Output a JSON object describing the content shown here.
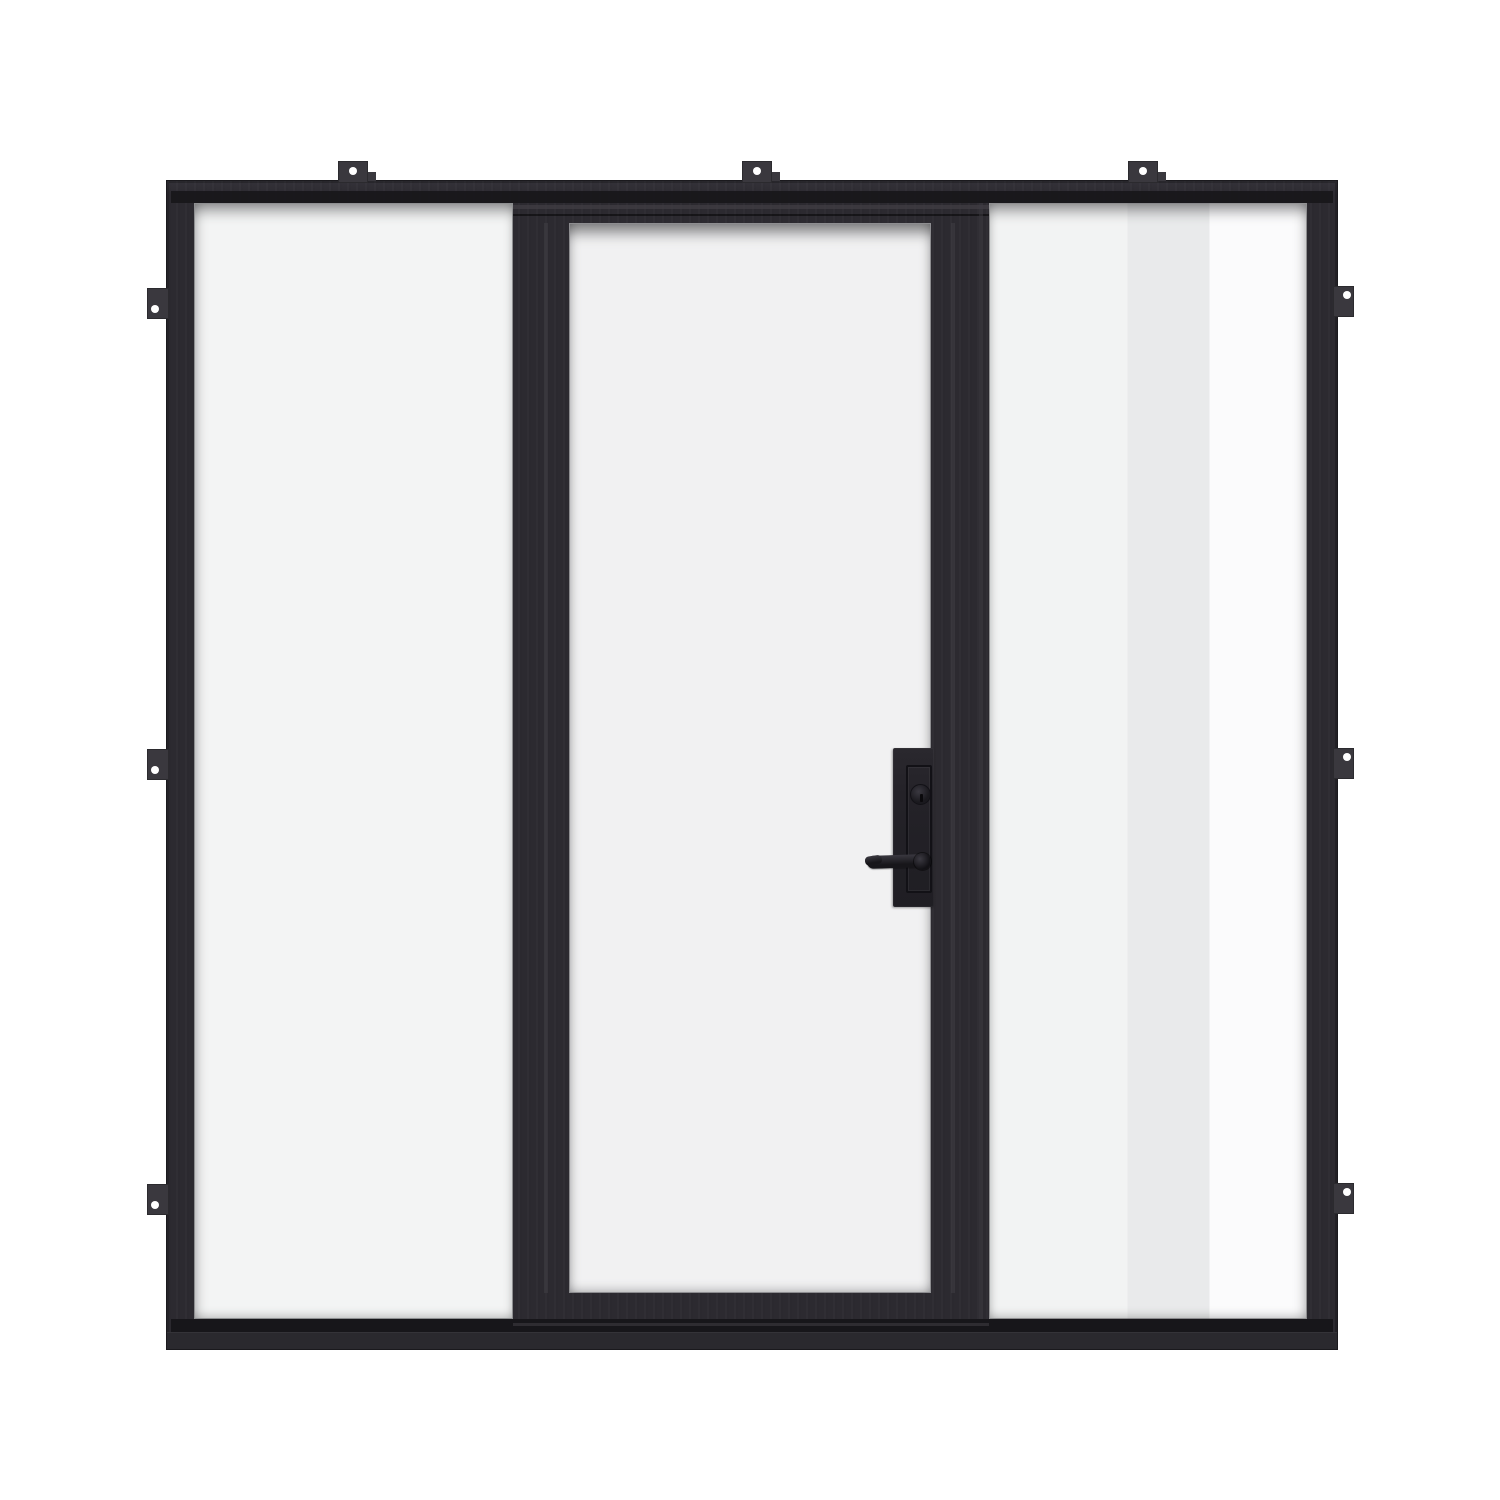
{
  "scene": {
    "type": "product render",
    "subject": "Black steel-frame single glass door with two full-height glass sidelights and exterior mounting tabs",
    "parts": {
      "frame": "welded black steel perimeter frame",
      "left_sidelight": "fixed clear glass sidelight panel",
      "door": "hinged single-lite clear glass door",
      "right_sidelight": "fixed clear glass sidelight panel with vertical reflection band",
      "lock_plate": "rectangular black mortise lock plate",
      "deadbolt": "round deadbolt key cylinder",
      "handle": "black lever door handle pointing left",
      "threshold": "flat steel sill and threshold",
      "mounting_tabs": "steel installation tabs with single screw holes"
    },
    "counts": {
      "tabs_top": 3,
      "tabs_left": 3,
      "tabs_right": 3,
      "screw_holes_per_tab": 1,
      "glass_panels": 3
    }
  },
  "colors": {
    "bg": "#ffffff",
    "frame": "#2c2a30",
    "frame_light": "#343239",
    "frame_edge": "#1a191d",
    "frame_dark": "#17161a",
    "frame_seam": "#413f45",
    "frame_base": "#2a292e",
    "tab": "#3a383e",
    "screw_hole": "#ffffff",
    "glass_side": "#f3f4f4",
    "glass_door": "#f1f1f2",
    "glass_r1": "#f2f3f3",
    "glass_r2": "#e9eaeb",
    "glass_r3": "#fbfbfc",
    "hw": "#242228",
    "hw_dark": "#121116"
  }
}
